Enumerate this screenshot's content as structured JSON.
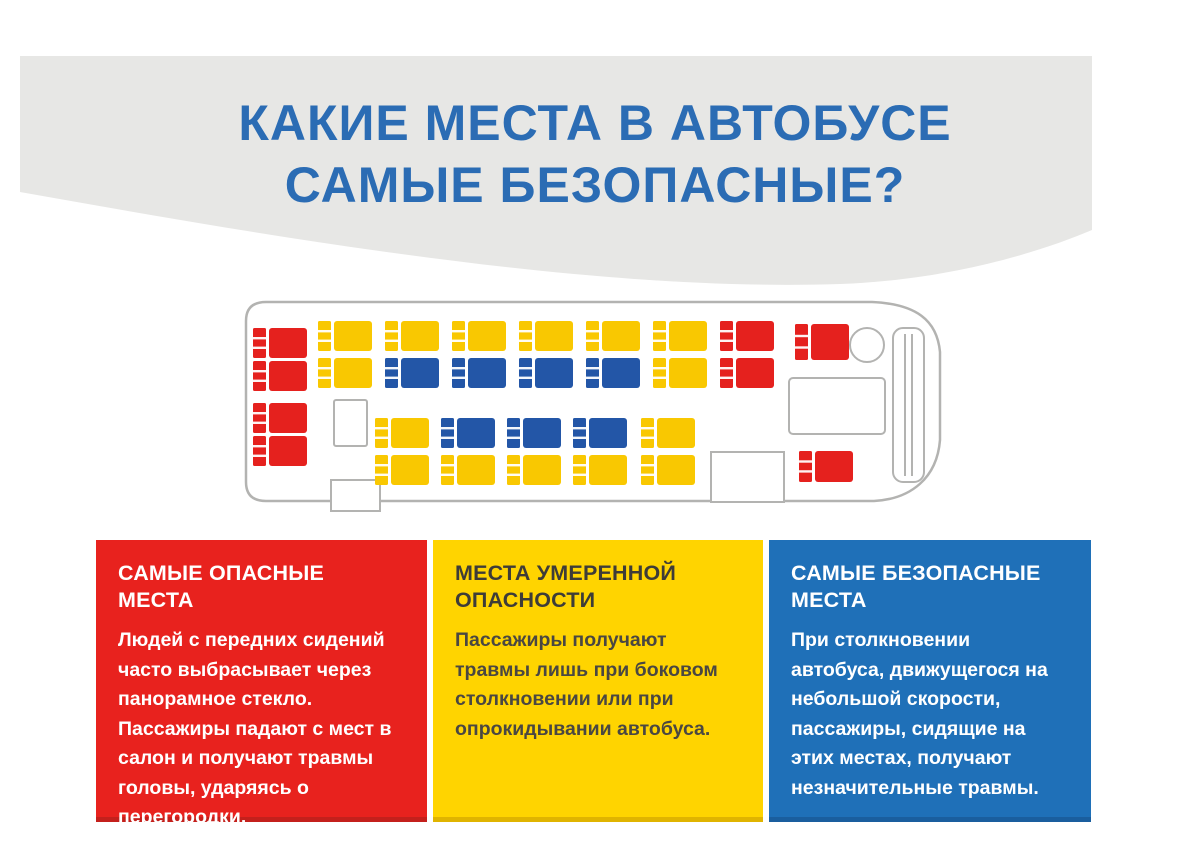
{
  "page": {
    "background": "#ffffff",
    "band_color": "#e7e7e5"
  },
  "title": {
    "line1": "КАКИЕ МЕСТА В АВТОБУСЕ",
    "line2": "САМЫЕ БЕЗОПАСНЫЕ?",
    "color": "#2b6cb4"
  },
  "bus": {
    "outline_color": "#b3b3b1",
    "seat_colors": {
      "red": "#e5211e",
      "yellow": "#f9c801",
      "blue": "#2356a7"
    },
    "seat_size": {
      "back_w": 13,
      "gap": 3,
      "cushion_w": 38,
      "h": 30
    },
    "seats": [
      {
        "x": 253,
        "y": 328,
        "c": "red"
      },
      {
        "x": 253,
        "y": 361,
        "c": "red"
      },
      {
        "x": 253,
        "y": 403,
        "c": "red"
      },
      {
        "x": 253,
        "y": 436,
        "c": "red"
      },
      {
        "x": 318,
        "y": 321,
        "c": "yellow"
      },
      {
        "x": 385,
        "y": 321,
        "c": "yellow"
      },
      {
        "x": 452,
        "y": 321,
        "c": "yellow"
      },
      {
        "x": 519,
        "y": 321,
        "c": "yellow"
      },
      {
        "x": 586,
        "y": 321,
        "c": "yellow"
      },
      {
        "x": 653,
        "y": 321,
        "c": "yellow"
      },
      {
        "x": 720,
        "y": 321,
        "c": "red"
      },
      {
        "x": 318,
        "y": 358,
        "c": "yellow"
      },
      {
        "x": 385,
        "y": 358,
        "c": "blue"
      },
      {
        "x": 452,
        "y": 358,
        "c": "blue"
      },
      {
        "x": 519,
        "y": 358,
        "c": "blue"
      },
      {
        "x": 586,
        "y": 358,
        "c": "blue"
      },
      {
        "x": 653,
        "y": 358,
        "c": "yellow"
      },
      {
        "x": 720,
        "y": 358,
        "c": "red"
      },
      {
        "x": 375,
        "y": 418,
        "c": "yellow"
      },
      {
        "x": 441,
        "y": 418,
        "c": "blue"
      },
      {
        "x": 507,
        "y": 418,
        "c": "blue"
      },
      {
        "x": 573,
        "y": 418,
        "c": "blue"
      },
      {
        "x": 641,
        "y": 418,
        "c": "yellow"
      },
      {
        "x": 375,
        "y": 455,
        "c": "yellow"
      },
      {
        "x": 441,
        "y": 455,
        "c": "yellow"
      },
      {
        "x": 507,
        "y": 455,
        "c": "yellow"
      },
      {
        "x": 573,
        "y": 455,
        "c": "yellow"
      },
      {
        "x": 641,
        "y": 455,
        "c": "yellow"
      },
      {
        "x": 795,
        "y": 324,
        "c": "red",
        "h": 36
      },
      {
        "x": 799,
        "y": 451,
        "c": "red",
        "h": 31
      }
    ]
  },
  "cards": [
    {
      "id": "most-dangerous",
      "bg": "#e8221e",
      "title": "САМЫЕ ОПАСНЫЕ МЕСТА",
      "title_color": "#ffffff",
      "text": "Людей с передних сидений часто выбрасывает через панорамное стекло. Пассажиры падают с мест в салон и получают травмы головы, ударяясь о перегородки.",
      "text_color": "#ffffff"
    },
    {
      "id": "moderate-danger",
      "bg": "#ffd400",
      "title": "МЕСТА УМЕРЕННОЙ ОПАСНОСТИ",
      "title_color": "#3e3c38",
      "text": "Пассажиры получают травмы лишь при боковом столкновении или при опрокидывании автобуса.",
      "text_color": "#4a4742"
    },
    {
      "id": "safest",
      "bg": "#1f70b8",
      "title": "САМЫЕ БЕЗОПАСНЫЕ МЕСТА",
      "title_color": "#ffffff",
      "text": "При столкновении автобуса, движущегося на небольшой скорости, пассажиры, сидящие на этих местах, получают незначительные травмы.",
      "text_color": "#ffffff"
    }
  ]
}
